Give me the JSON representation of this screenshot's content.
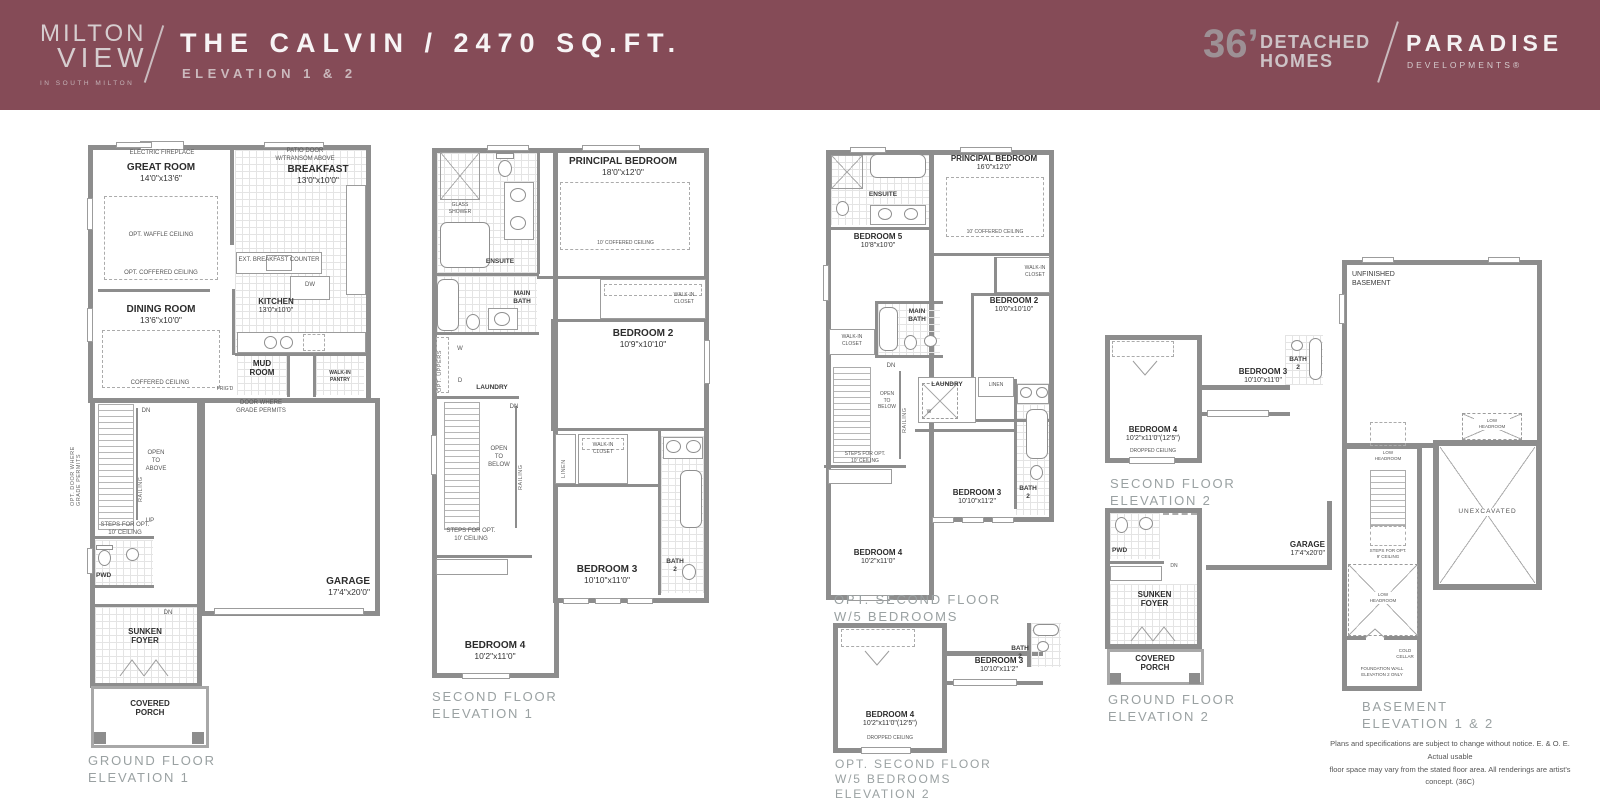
{
  "header": {
    "bg_color": "#854B57",
    "logo_line1": "MILTON",
    "logo_line2": "VIEW",
    "logo_sub": "IN SOUTH MILTON",
    "title": "THE CALVIN / 2470 SQ.FT.",
    "subtitle": "ELEVATION 1 & 2",
    "lot_size": "36’",
    "detached": "DETACHED",
    "homes": "HOMES",
    "brand": "PARADISE",
    "brand_sub": "DEVELOPMENTS®"
  },
  "shared": {
    "glass_shower": "GLASS\nSHOWER",
    "ensuite": "ENSUITE",
    "main_bath": "MAIN\nBATH",
    "walk_in_closet": "WALK-IN\nCLOSET",
    "walk_in_pantry": "WALK-IN\nPANTRY",
    "laundry": "LAUNDRY",
    "linen": "LINEN",
    "railing": "RAILING",
    "open_to_below": "OPEN\nTO\nBELOW",
    "open_to_above": "OPEN\nTO\nABOVE",
    "steps_opt_10": "STEPS FOR OPT.\n10' CEILING",
    "steps_opt_9": "STEPS FOR OPT.\n9' CEILING",
    "dn": "DN",
    "up": "UP",
    "w": "W",
    "d": "D",
    "dw": "DW",
    "opt_uppers": "OPT. UPPERS",
    "dropped_ceiling": "DROPPED CEILING",
    "coffered_10": "10' COFFERED CEILING",
    "low_headroom": "LOW\nHEADROOM",
    "bath_2": "BATH\n2",
    "pwd": "PWD",
    "sunken_foyer": "SUNKEN\nFOYER",
    "covered_porch": "COVERED\nPORCH",
    "garage": "GARAGE",
    "garage_dims": "17'4\"x20'0\"",
    "principal_bedroom": "PRINCIPAL BEDROOM",
    "bedroom_2": "BEDROOM 2",
    "bedroom_3": "BEDROOM 3",
    "bedroom_4": "BEDROOM 4",
    "bedroom_5": "BEDROOM 5"
  },
  "ground1": {
    "caption": "GROUND FLOOR\nELEVATION 1",
    "great_room": "GREAT ROOM",
    "great_room_dims": "14'0\"x13'6\"",
    "breakfast": "BREAKFAST",
    "breakfast_dims": "13'0\"x10'0\"",
    "dining_room": "DINING ROOM",
    "dining_room_dims": "13'6\"x10'0\"",
    "kitchen": "KITCHEN",
    "kitchen_dims": "13'0\"x10'0\"",
    "mud_room": "MUD\nROOM",
    "electric_fireplace": "ELECTRIC FIREPLACE",
    "opt_waffle": "OPT. WAFFLE CEILING",
    "opt_coffered": "OPT. COFFERED CEILING",
    "coffered": "COFFERED CEILING",
    "patio_door": "PATIO DOOR\nW/TRANSOM ABOVE",
    "ext_counter": "EXT. BREAKFAST COUNTER",
    "frigd": "FRIG'D",
    "door_grade": "DOOR WHERE\nGRADE PERMITS",
    "opt_door_grade": "OPT. DOOR WHERE\nGRADE PERMITS"
  },
  "second1": {
    "caption": "SECOND FLOOR\nELEVATION 1",
    "principal_dims": "18'0\"x12'0\"",
    "bed2_dims": "10'9\"x10'10\"",
    "bed3_dims": "10'10\"x11'0\"",
    "bed4_dims": "10'2\"x11'0\""
  },
  "opt1": {
    "caption": "OPT. SECOND FLOOR\nW/5 BEDROOMS\nELEVATION 1",
    "principal_dims": "16'0\"x12'0\"",
    "bed5_dims": "10'8\"x10'0\"",
    "bed2_dims": "10'0\"x10'10\"",
    "bed3_dims": "10'10\"x11'2\"",
    "bed4_dims": "10'2\"x11'0\""
  },
  "opt2": {
    "caption": "OPT. SECOND FLOOR\nW/5 BEDROOMS\nELEVATION 2",
    "bed4_dims": "10'2\"x11'0\"(12'5\")",
    "bed3_dims": "10'10\"x11'2\""
  },
  "second2": {
    "caption": "SECOND FLOOR\nELEVATION 2",
    "bed4_dims": "10'2\"x11'0\"(12'5\")",
    "bed3_dims": "10'10\"x11'0\""
  },
  "ground2": {
    "caption": "GROUND FLOOR\nELEVATION 2"
  },
  "basement": {
    "caption": "BASEMENT\nELEVATION 1 & 2",
    "unfinished": "UNFINISHED\nBASEMENT",
    "unexcavated": "UNEXCAVATED",
    "cold_cellar": "COLD\nCELLAR",
    "foundation_note": "FOUNDATION WALL\nELEVATION 2 ONLY"
  },
  "disclaimer": "Plans and specifications are subject to change without notice. E. & O. E. Actual usable\nfloor space may vary from the stated floor area. All renderings are artist's concept. (36C)"
}
